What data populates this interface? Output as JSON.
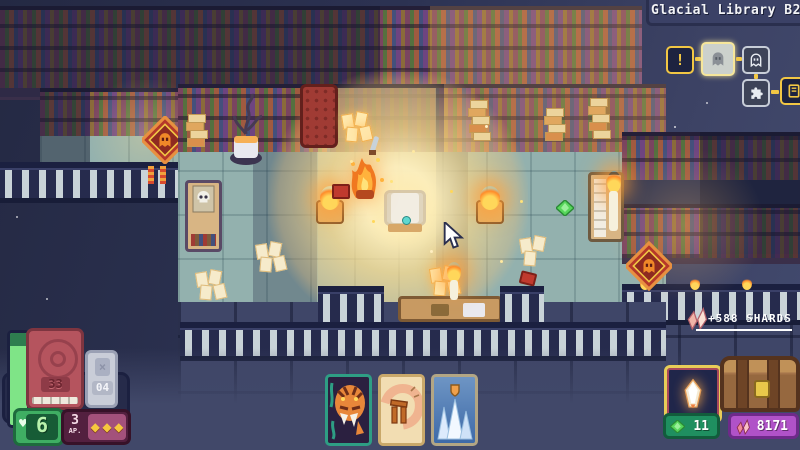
{
  "colors": {
    "accent_gold": "#f2c744",
    "hp_green": "#7fe487",
    "light_warm": "#ffd98a",
    "rug_red": "#b5382a",
    "gem_green": "#57d65b",
    "shard_pink": "#f0b4a8",
    "green_badge": "#1f8f60",
    "purple_badge": "#b052c8",
    "card_teal_border": "#2e9e84"
  },
  "hud": {
    "location": {
      "title": "Glacial Library B2"
    },
    "map": {
      "nodes": [
        {
          "label": "!",
          "icon": "exclamation-icon",
          "state": "completed"
        },
        {
          "icon": "ghost-icon",
          "state": "current"
        },
        {
          "icon": "ghost-icon",
          "state": "upcoming"
        },
        {
          "icon": "puzzle-icon",
          "state": "upcoming"
        },
        {
          "icon": "door-icon",
          "state": "upcoming"
        }
      ]
    },
    "shard_gain": {
      "text": "+588 SHARDS",
      "icon": "shards-icon"
    },
    "deck": {
      "draw_count": "33",
      "discard_count": "04",
      "discard_icon_glyph": "×"
    },
    "health": {
      "value": "6",
      "heart_glyph": "♥"
    },
    "action_points": {
      "value": "3",
      "unit": "AP.",
      "pip_glyph": "◆",
      "pip_count": 3
    },
    "hand": [
      {
        "name": "tiger-card"
      },
      {
        "name": "table-flip-card"
      },
      {
        "name": "ice-wall-card"
      }
    ],
    "loot": {
      "relic": "glowing-shard-relic"
    },
    "currency": {
      "gems": "11",
      "shards": "8171"
    }
  },
  "scene": {
    "props": [
      "bookshelves",
      "ghost-rug",
      "dead-plant",
      "skull-cabinet",
      "red-cabinet",
      "reward-shrine",
      "burning-hero",
      "lantern",
      "scattered-papers",
      "book-pile",
      "green-gem",
      "candle",
      "treasure-room-railings"
    ]
  }
}
